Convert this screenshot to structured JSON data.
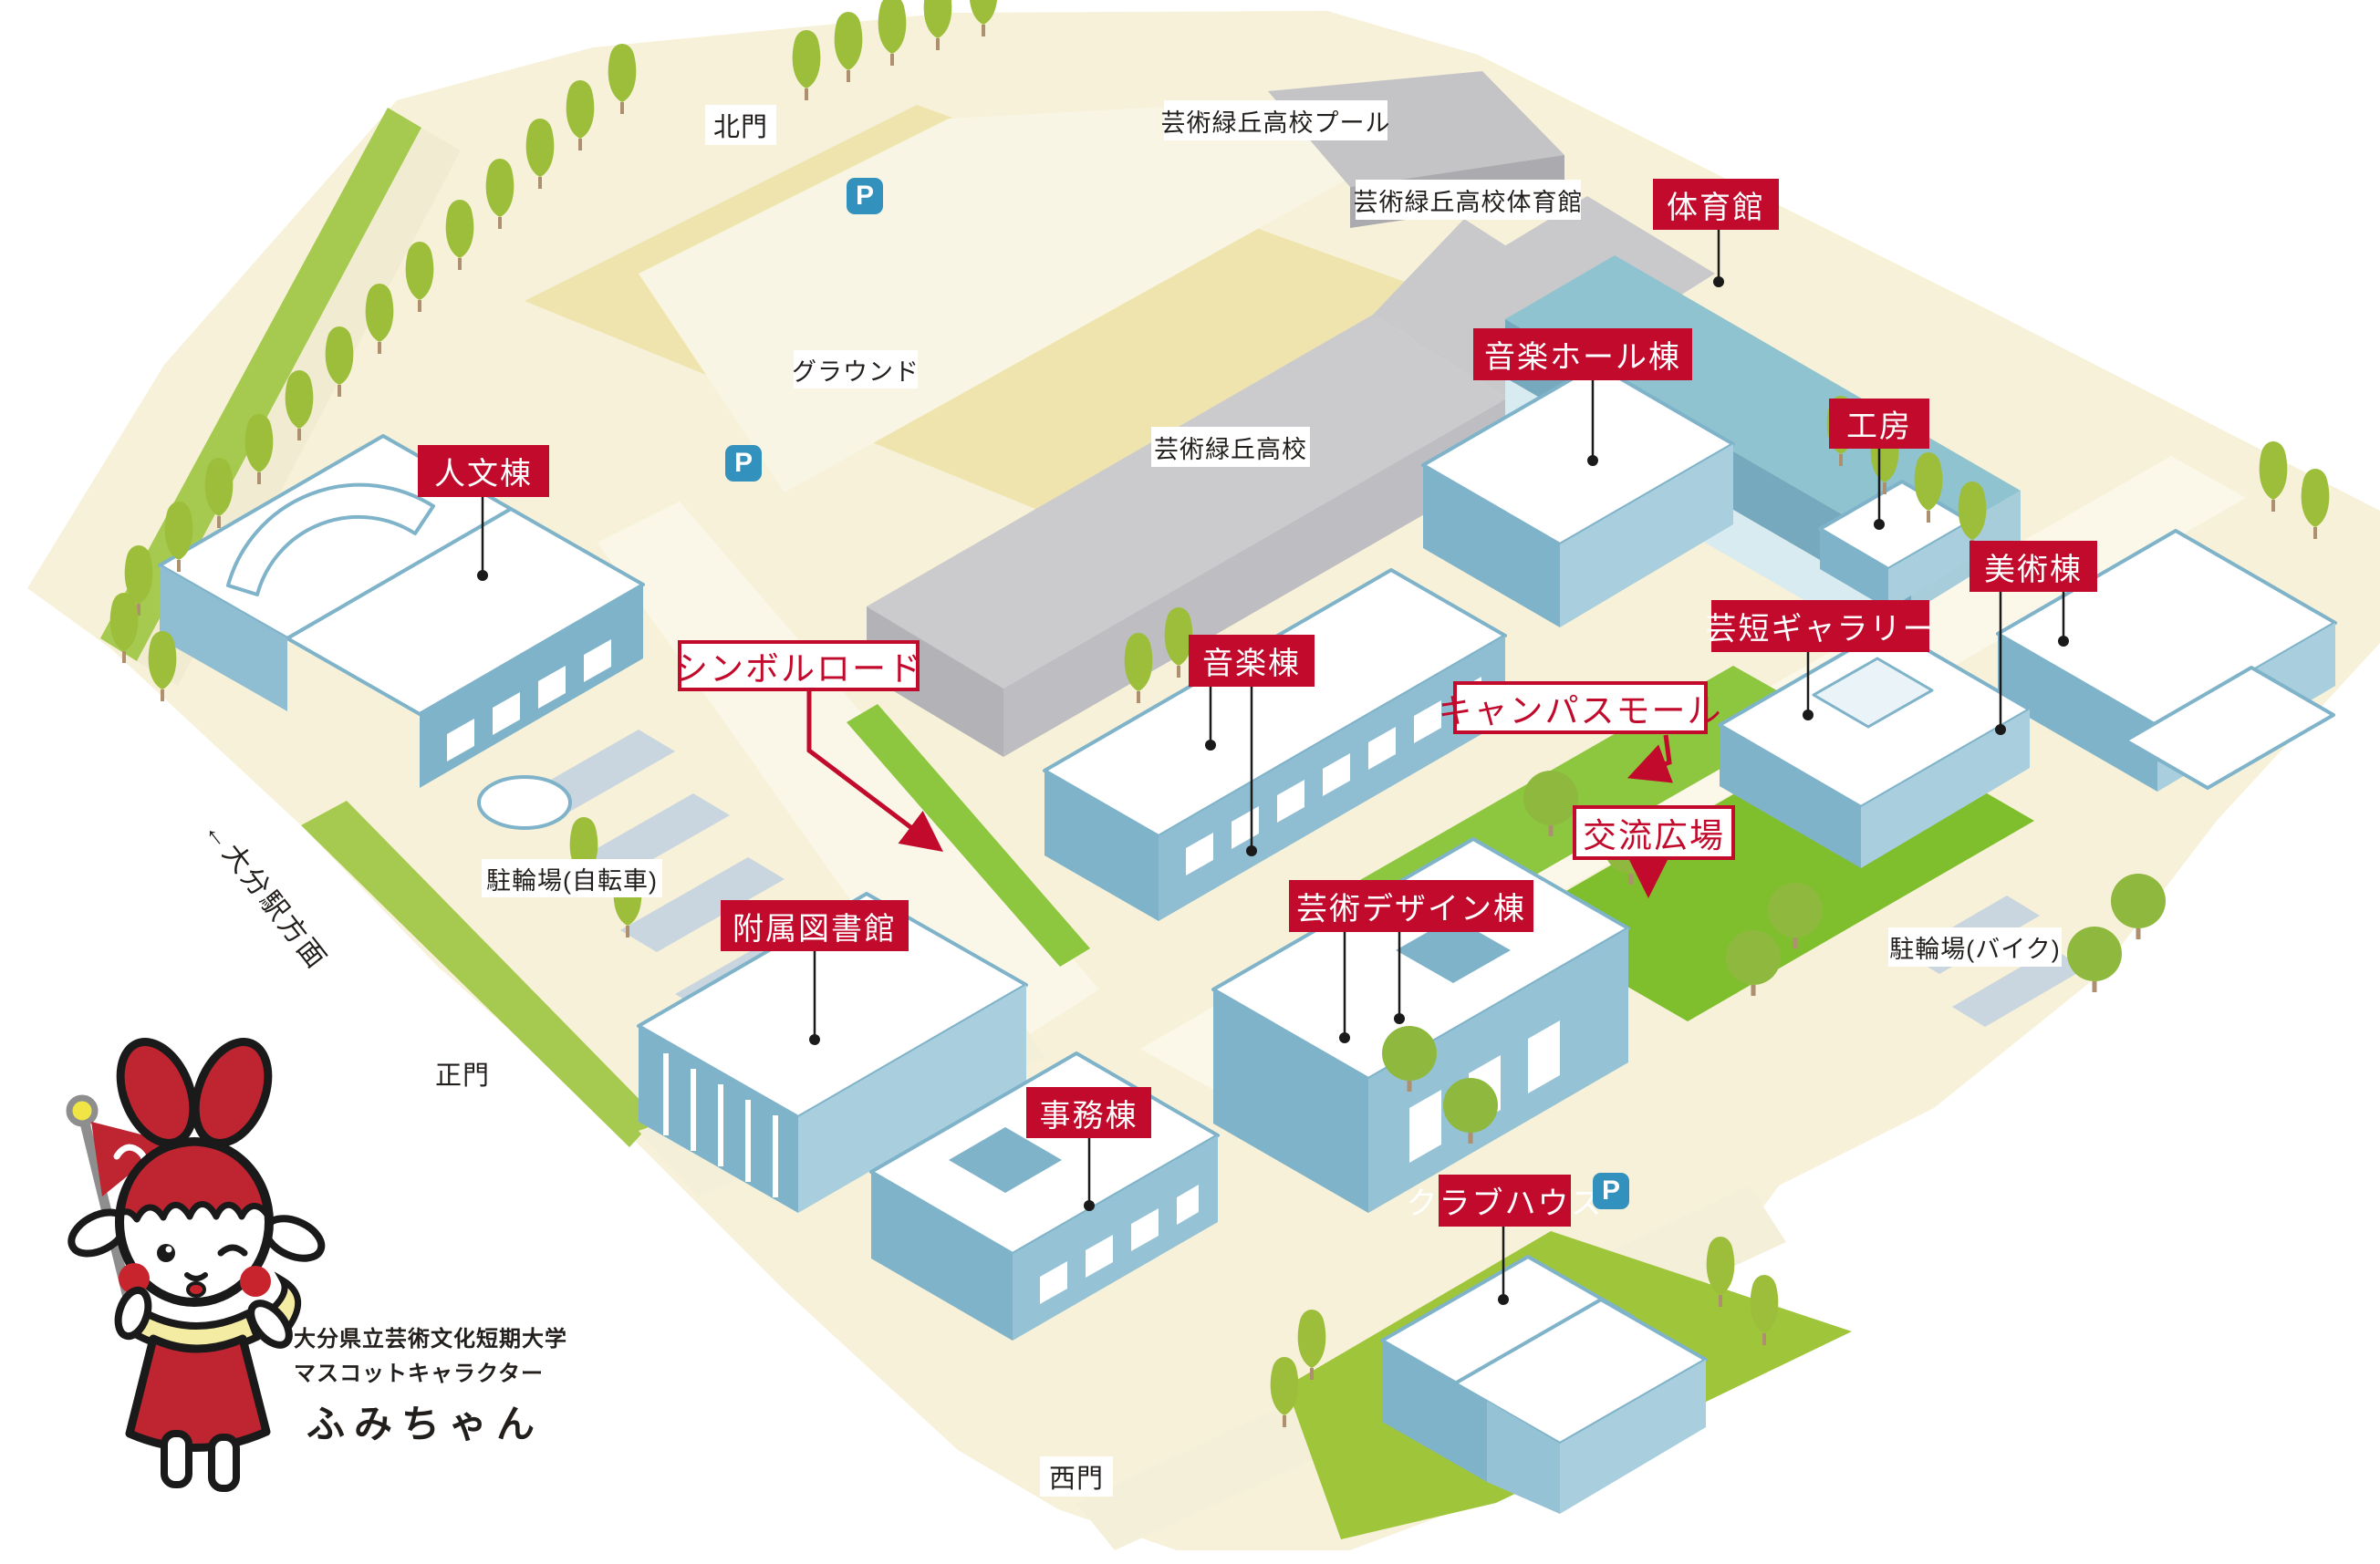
{
  "buildings": {
    "taiikukan": {
      "label": "体育館"
    },
    "ongaku_hall": {
      "label": "音楽ホール棟"
    },
    "kobo": {
      "label": "工房"
    },
    "jinbun": {
      "label": "人文棟"
    },
    "bijutsu": {
      "label": "美術棟"
    },
    "geitan_gallery": {
      "label": "芸短ギャラリー"
    },
    "ongaku": {
      "label": "音楽棟"
    },
    "toshokan": {
      "label": "附属図書館"
    },
    "geijutsu_design": {
      "label": "芸術デザイン棟"
    },
    "jimu": {
      "label": "事務棟"
    },
    "clubhouse": {
      "label": "クラブハウス"
    }
  },
  "areas": {
    "symbol_road": {
      "label": "シンボルロード"
    },
    "campus_mall": {
      "label": "キャンパスモール"
    },
    "koryu_hiroba": {
      "label": "交流広場"
    }
  },
  "places": {
    "pool": {
      "label": "芸術緑丘高校プール"
    },
    "hs_gym": {
      "label": "芸術緑丘高校体育館"
    },
    "ground": {
      "label": "グラウンド"
    },
    "high_school": {
      "label": "芸術緑丘高校"
    },
    "bicycle_parking": {
      "label": "駐輪場(自転車)"
    },
    "bike_parking": {
      "label": "駐輪場(バイク)"
    }
  },
  "gates": {
    "north": {
      "label": "北門"
    },
    "main": {
      "label": "正門"
    },
    "west": {
      "label": "西門"
    }
  },
  "direction_sign": {
    "label": "←大分駅方面"
  },
  "parking_symbol": "P",
  "mascot": {
    "org": "大分県立芸術文化短期大学",
    "role": "マスコットキャラクター",
    "name": "ふみちゃん"
  },
  "colors": {
    "badge_red": "#C20B2C",
    "badge_text": "#FFFFFF",
    "parking_blue": "#3391BD",
    "label_black": "#221E1C",
    "land_cream": "#F6F1D8",
    "field_yellow": "#EFE4AE",
    "path_light": "#FBF8EA",
    "grass_green": "#9FC63B",
    "mall_green": "#7FBE2D",
    "building_blue": "#7FB3C9",
    "building_blue_light": "#A9CEDE",
    "roof_teal": "#8FC3CF",
    "hs_gray": "#C9C9CC",
    "tree_green": "#9CBE3B",
    "mascot_red": "#BE2530",
    "scarf_yellow": "#F5ECA3"
  }
}
